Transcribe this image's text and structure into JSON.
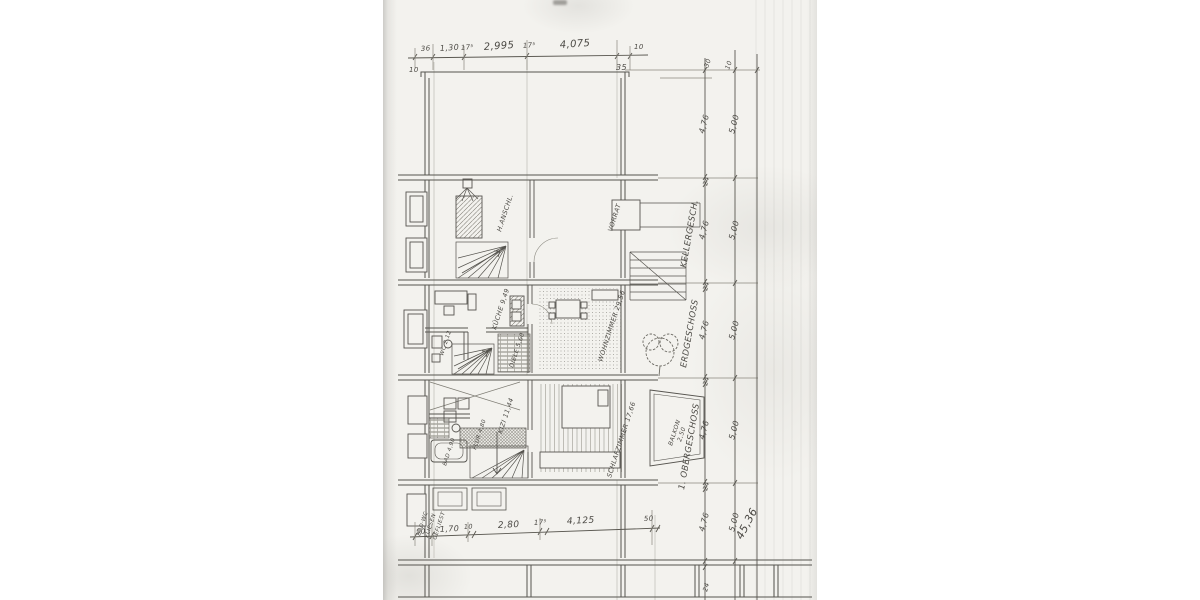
{
  "document": {
    "kind": "scanned hand-drawn architectural floor plan",
    "language": "German"
  },
  "dims": {
    "top": [
      "10",
      "36",
      "1,30",
      "17⁵",
      "2,995",
      "17⁵",
      "4,075",
      "35",
      "10"
    ],
    "bottom": [
      "50",
      "1,70",
      "10",
      "2,80",
      "17⁵",
      "4,125",
      "50"
    ],
    "heights": [
      "4,76",
      "4,76",
      "4,76",
      "4,76",
      "4,76"
    ],
    "widths": [
      "5,00",
      "5,00",
      "5,00",
      "5,00",
      "5,00"
    ],
    "slabs": [
      "24",
      "24",
      "24",
      "24",
      "24"
    ],
    "offsets": [
      "30",
      "10"
    ],
    "total": "45,36"
  },
  "floors": {
    "basement": "KELLERGESCH.",
    "ground": "ERDGESCHOSS",
    "upper": "1. OBERGESCHOSS"
  },
  "rooms": {
    "service": "H.ANSCHL.",
    "storage": "VORRAT",
    "kitchen": "KÜCHE 9,49",
    "living": "WOHNZIMMER 29,56",
    "hall_eg": "DIELE 5,60",
    "wc": "WC 2,12",
    "child": "KIZI 11,44",
    "bedroom": "SCHLAFZIMMER 17,66",
    "hall_og": "FLUR 4,80",
    "bath": "BAD 4,90",
    "balcony_1": "BALKON",
    "balcony_2": "2,50",
    "note_1": "BAD·WC",
    "note_2": "FLIESEN",
    "note_3": "GEFLIEST"
  },
  "colors": {
    "paper": "#f3f2ee",
    "ink": "#56544f",
    "faint": "#a09d96"
  }
}
